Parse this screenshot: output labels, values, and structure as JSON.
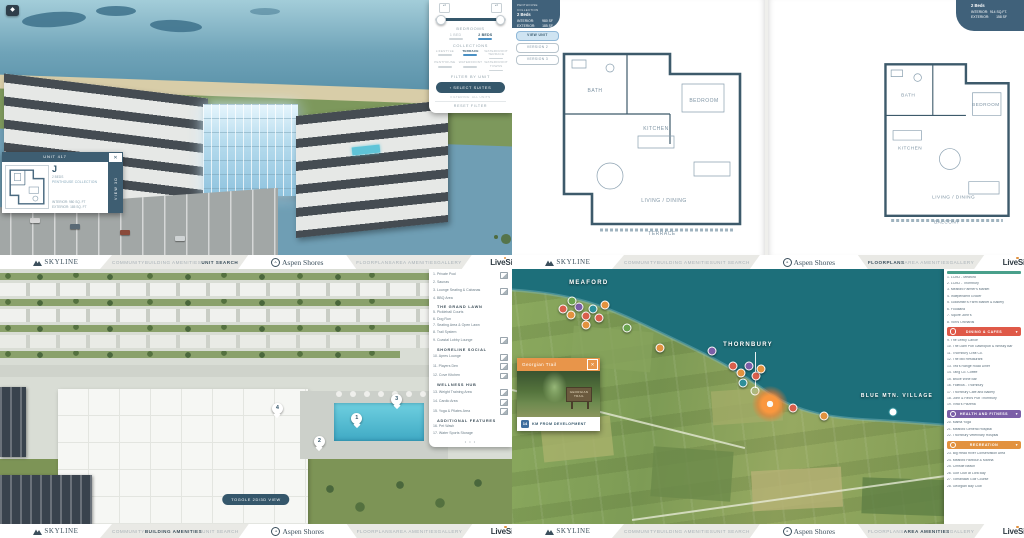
{
  "brand": {
    "skyline": "SKYLINE",
    "aspen_shores": "Aspen Shores",
    "aspen_badge": "A",
    "livesite": "LiveSite"
  },
  "nav": {
    "left_items": [
      "COMMUNITY",
      "BUILDING AMENITIES",
      "UNIT SEARCH"
    ],
    "right_items": [
      "FLOORPLANS",
      "AREA AMENITIES",
      "GALLERY"
    ],
    "active": {
      "q1": "UNIT SEARCH",
      "q2": "FLOORPLANS",
      "q3": "BUILDING AMENITIES",
      "q4": "AREA AMENITIES"
    }
  },
  "icons": {
    "close": "✕",
    "chevron_down": "▾",
    "dots": "• • •",
    "stepper": "▴\n▾",
    "compass": "◆"
  },
  "q1": {
    "filter": {
      "bedrooms_label": "BEDROOMS",
      "bedroom_options": [
        {
          "label": "1 BED",
          "active": false
        },
        {
          "label": "2 BEDS",
          "active": true
        }
      ],
      "collections_label": "COLLECTIONS",
      "collections": [
        {
          "label": "LIFESTYLE",
          "active": false
        },
        {
          "label": "TERRACE",
          "active": true
        },
        {
          "label": "WATERFRONT TERRACE",
          "active": false
        },
        {
          "label": "PENTHOUSE",
          "active": false
        },
        {
          "label": "WATERFRONT",
          "active": false
        },
        {
          "label": "WATERFRONT TOWNS",
          "active": false
        }
      ],
      "filter_by_unit_label": "FILTER BY UNIT",
      "select_suites_button": "‹  SELECT SUITES",
      "filtering_note": "FILTERING: ALL UNITS",
      "reset_filter": "RESET FILTER"
    },
    "unit_card": {
      "title": "UNIT 417",
      "plan_letter": "J",
      "beds": "2 BEDS",
      "collection": "PENTHOUSE COLLECTION",
      "interior": "INTERIOR:  980 SQ. FT",
      "exterior": "EXTERIOR:  185 SQ. FT",
      "view_3d": "VIEW 3D"
    }
  },
  "q2": {
    "left_spec": {
      "collection": "PENTHOUSE COLLECTION",
      "beds": "2 Beds",
      "interior_label": "INTERIOR:",
      "interior_value": "980 SF",
      "exterior_label": "EXTERIOR:",
      "exterior_value": "185 SF"
    },
    "version_buttons": [
      {
        "label": "VIEW UNIT",
        "active": true
      },
      {
        "label": "VERSION 2",
        "active": false
      },
      {
        "label": "VERSION 3",
        "active": false
      }
    ],
    "right_spec": {
      "beds": "2 Beds",
      "interior_label": "INTERIOR:",
      "interior_value": "914 SQ.FT.",
      "exterior_label": "EXTERIOR:",
      "exterior_value": "158 SF"
    },
    "plan_a_rooms": [
      "BATH",
      "BEDROOM",
      "KITCHEN",
      "LIVING / DINING",
      "TERRACE"
    ],
    "plan_b_rooms": [
      "BATH",
      "BEDROOM",
      "KITCHEN",
      "LIVING / DINING",
      "BALCONY"
    ]
  },
  "q3": {
    "toggle_button": "TOGGLE 2D/3D VIEW",
    "sections": [
      {
        "header": "",
        "items": [
          {
            "n": "1",
            "label": "Private Pool",
            "img": true
          },
          {
            "n": "2",
            "label": "Saunas",
            "img": false
          },
          {
            "n": "3",
            "label": "Lounge Seating & Cabanas",
            "img": true
          },
          {
            "n": "4",
            "label": "BBQ Area",
            "img": false
          }
        ]
      },
      {
        "header": "THE GRAND LAWN",
        "items": [
          {
            "n": "5",
            "label": "Pickleball Courts",
            "img": false
          },
          {
            "n": "6",
            "label": "Dog Run",
            "img": false
          },
          {
            "n": "7",
            "label": "Seating Area & Open Lawn",
            "img": false
          },
          {
            "n": "8",
            "label": "Trail System",
            "img": false
          },
          {
            "n": "9",
            "label": "Coastal Lobby Lounge",
            "img": true
          }
        ]
      },
      {
        "header": "SHORELINE SOCIAL",
        "items": [
          {
            "n": "10",
            "label": "Apres Lounge",
            "img": true
          },
          {
            "n": "11",
            "label": "Players Den",
            "img": true
          },
          {
            "n": "12",
            "label": "Cove Kitchen",
            "img": true
          }
        ]
      },
      {
        "header": "WELLNESS HUB",
        "items": [
          {
            "n": "13",
            "label": "Weight Training Area",
            "img": true
          },
          {
            "n": "14",
            "label": "Cardio Area",
            "img": true
          },
          {
            "n": "15",
            "label": "Yoga & Pilates Area",
            "img": true
          }
        ]
      },
      {
        "header": "ADDITIONAL FEATURES",
        "items": [
          {
            "n": "16",
            "label": "Pet Wash",
            "img": false
          },
          {
            "n": "17",
            "label": "Water Sports Storage",
            "img": false
          }
        ]
      }
    ],
    "markers": [
      {
        "n": "1",
        "x": 68.6,
        "y": 56.5
      },
      {
        "n": "2",
        "x": 61.3,
        "y": 65.5
      },
      {
        "n": "3",
        "x": 76.4,
        "y": 49.0
      },
      {
        "n": "4",
        "x": 53.1,
        "y": 52.5
      }
    ]
  },
  "q4": {
    "labels": [
      {
        "text": "MEAFORD",
        "x": 15.0,
        "y": 5.5
      },
      {
        "text": "THORNBURY",
        "x": 46.1,
        "y": 29.8
      },
      {
        "text": "BLUE MTN. VILLAGE",
        "x": 75.2,
        "y": 49.8
      }
    ],
    "popup": {
      "title": "Georgian Trail",
      "sign_text": "GEORGIAN TRAIL",
      "distance_value": "14",
      "distance_label": "KM FROM DEVELOPMENT"
    },
    "legend_groups": [
      {
        "header": "",
        "color": "",
        "items": [
          {
            "n": "1",
            "label": "LCBO - Meaford"
          },
          {
            "n": "2",
            "label": "LCBO - Thornbury"
          },
          {
            "n": "3",
            "label": "Meaford Farmer's Market"
          },
          {
            "n": "4",
            "label": "Independent Grocer"
          },
          {
            "n": "5",
            "label": "Goldsmith's Farm Market & Bakery"
          },
          {
            "n": "6",
            "label": "Foodland"
          },
          {
            "n": "7",
            "label": "Squire John's"
          },
          {
            "n": "8",
            "label": "Von's Orchards"
          }
        ]
      },
      {
        "header": "DINING & CAFES",
        "color": "#df5948",
        "items": [
          {
            "n": "9",
            "label": "The Leeky Canoe"
          },
          {
            "n": "10",
            "label": "The Dam Pub Gastropub & Whisky Bar"
          },
          {
            "n": "11",
            "label": "Thornbury Craft Co."
          },
          {
            "n": "12",
            "label": "The Mill Restaurant"
          },
          {
            "n": "13",
            "label": "Ted's Range Road Diner"
          },
          {
            "n": "14",
            "label": "Tang Co. Coffee"
          },
          {
            "n": "15",
            "label": "Bruce Wine Bar"
          },
          {
            "n": "16",
            "label": "Fidelica - Thornbury"
          },
          {
            "n": "17",
            "label": "Thornbury Cafe and Bakery"
          },
          {
            "n": "18",
            "label": "John & Red's Pub Thornbury"
          },
          {
            "n": "19",
            "label": "Vinci's Pizzeria"
          }
        ]
      },
      {
        "header": "HEALTH AND FITNESS",
        "color": "#7b5ea7",
        "items": [
          {
            "n": "20",
            "label": "Mama Yoga"
          },
          {
            "n": "21",
            "label": "Meaford General Hospital"
          },
          {
            "n": "22",
            "label": "Thornbury Veterinary Hospital"
          }
        ]
      },
      {
        "header": "RECREATION",
        "color": "#e2923f",
        "items": [
          {
            "n": "23",
            "label": "Big Head River Conservation Area"
          },
          {
            "n": "24",
            "label": "Meaford Harbour & Marina"
          },
          {
            "n": "25",
            "label": "Christie Beach"
          },
          {
            "n": "26",
            "label": "Golf Club at Lora Bay"
          },
          {
            "n": "27",
            "label": "Tomahawk Golf Course"
          },
          {
            "n": "28",
            "label": "Georgian Bay Club"
          }
        ]
      }
    ],
    "pins": [
      {
        "x": 10.0,
        "y": 15.6,
        "c": "#d95f4c"
      },
      {
        "x": 11.5,
        "y": 18.2,
        "c": "#e2923f"
      },
      {
        "x": 13.1,
        "y": 14.9,
        "c": "#7b5ea7"
      },
      {
        "x": 14.5,
        "y": 18.6,
        "c": "#d95f4c"
      },
      {
        "x": 15.8,
        "y": 15.6,
        "c": "#2e8f9a"
      },
      {
        "x": 14.5,
        "y": 21.9,
        "c": "#e2923f"
      },
      {
        "x": 17.0,
        "y": 19.3,
        "c": "#d95f4c"
      },
      {
        "x": 11.7,
        "y": 12.6,
        "c": "#6aa34f"
      },
      {
        "x": 18.2,
        "y": 14.1,
        "c": "#e2923f"
      },
      {
        "x": 22.5,
        "y": 23.0,
        "c": "#6aa34f"
      },
      {
        "x": 28.9,
        "y": 30.9,
        "c": "#e2923f"
      },
      {
        "x": 39.1,
        "y": 32.3,
        "c": "#7b5ea7"
      },
      {
        "x": 43.2,
        "y": 37.9,
        "c": "#d95f4c"
      },
      {
        "x": 44.7,
        "y": 40.9,
        "c": "#e2923f"
      },
      {
        "x": 46.3,
        "y": 37.9,
        "c": "#7b5ea7"
      },
      {
        "x": 47.7,
        "y": 42.0,
        "c": "#d95f4c"
      },
      {
        "x": 45.1,
        "y": 44.6,
        "c": "#2e8f9a"
      },
      {
        "x": 48.6,
        "y": 39.4,
        "c": "#e2923f"
      },
      {
        "x": 54.9,
        "y": 54.6,
        "c": "#d95f4c"
      },
      {
        "x": 60.9,
        "y": 57.5,
        "c": "#e2923f"
      }
    ]
  },
  "colors": {
    "navy": "#35576b",
    "card_header": "#3e5e72",
    "active_blue": "#4a90c4",
    "dining": "#df5948",
    "health": "#7b5ea7",
    "recreation": "#e2923f",
    "water_deep": "#1d6f7a"
  }
}
